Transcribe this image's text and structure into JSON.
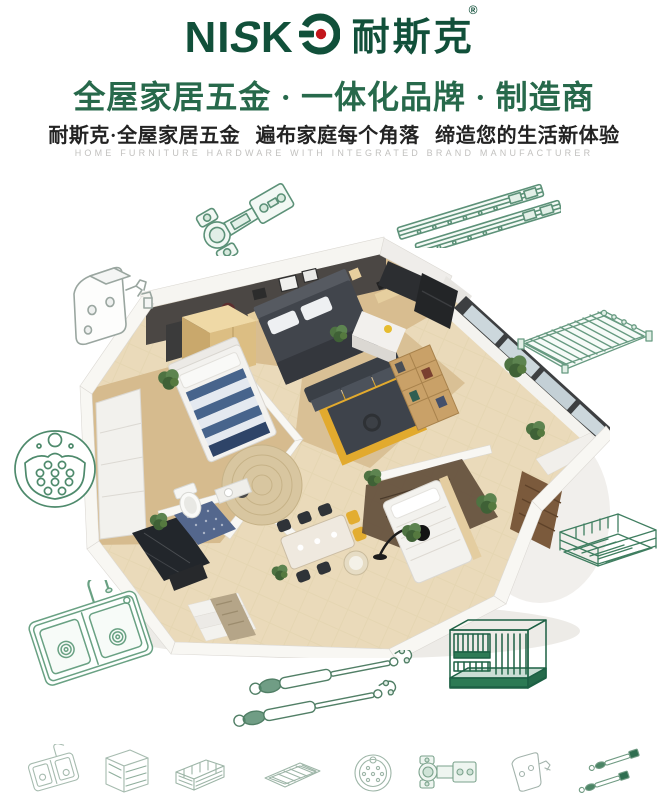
{
  "page": {
    "background": "#ffffff"
  },
  "brand": {
    "latin": "NISKO",
    "latin_ni": "NI",
    "latin_s": "S",
    "latin_k": "K",
    "cjk": "耐斯克",
    "registered": "®",
    "green": "#11503a",
    "red_dot": "#c3161c"
  },
  "headline": {
    "text": "全屋家居五金 · 一体化品牌 · 制造商",
    "color": "#27694b"
  },
  "subheadline": {
    "text": "耐斯克·全屋家居五金 遍布家庭每个角落 缔造您的生活新体验",
    "color": "#232323"
  },
  "tagline": {
    "text": "HOME FURNITURE HARDWARE WITH INTEGRATED BRAND MANUFACTURER",
    "color": "#c2c1bf"
  },
  "lineart_colors": {
    "green": "#5c9178",
    "dark_green": "#3f7e60",
    "gray": "#9aa6a0",
    "rack_green": "#1d6044",
    "light_green": "#a6bbaf"
  },
  "hardware_icons": {
    "top_left": "concealed-hinge-icon",
    "top_right": "drawer-slides-icon",
    "left_upper": "mounting-bracket-icon",
    "right_upper": "wire-shelf-icon",
    "left_mid": "sink-strainer-icon",
    "right_mid": "pull-out-basket-icon",
    "bottom_left": "double-bowl-sink-icon",
    "bottom_center": "gas-lift-struts-icon",
    "bottom_right": "kitchen-wire-rack-icon"
  },
  "bottom_row": [
    "double-bowl-sink-icon",
    "storage-cabinet-icon",
    "pull-out-basket-icon",
    "wire-shelf-icon",
    "sink-strainer-icon",
    "concealed-hinge-icon",
    "mounting-bracket-icon",
    "gas-lift-struts-icon"
  ]
}
